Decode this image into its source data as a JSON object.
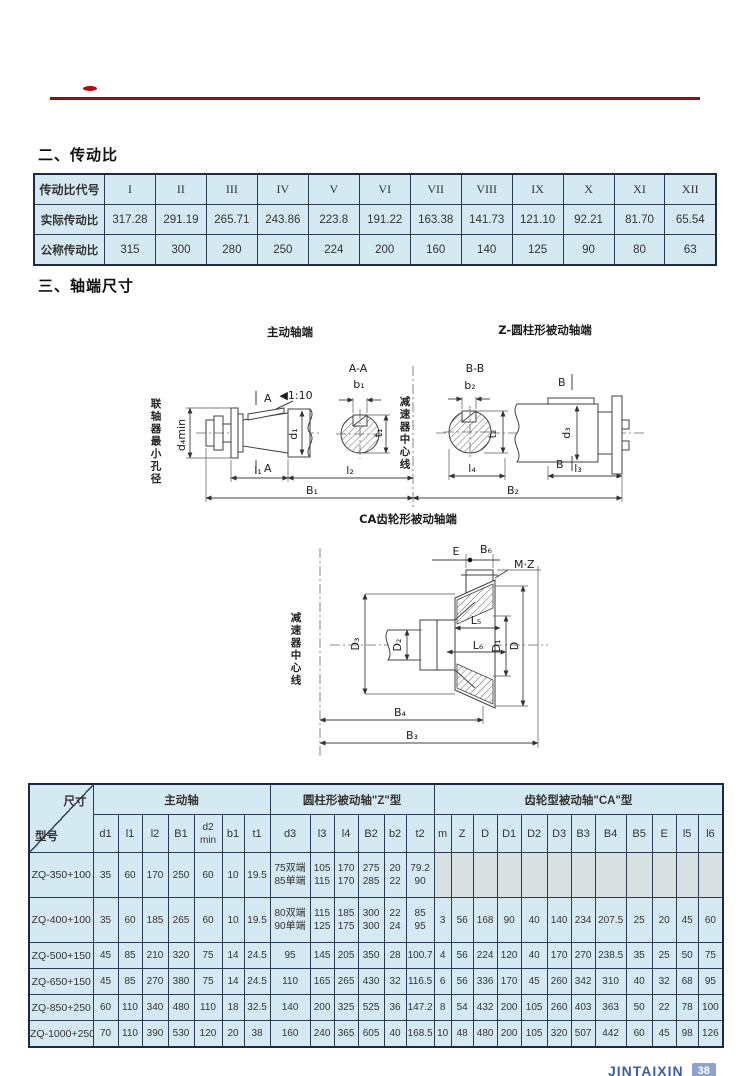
{
  "sections": {
    "ratio_title": "二、传动比",
    "shaft_title": "三、轴端尺寸"
  },
  "ratio_table": {
    "header_label": "传动比代号",
    "codes": [
      "I",
      "II",
      "III",
      "IV",
      "V",
      "VI",
      "VII",
      "VIII",
      "IX",
      "X",
      "XI",
      "XII"
    ],
    "actual_label": "实际传动比",
    "actual": [
      "317.28",
      "291.19",
      "265.71",
      "243.86",
      "223.8",
      "191.22",
      "163.38",
      "141.73",
      "121.10",
      "92.21",
      "81.70",
      "65.54"
    ],
    "nominal_label": "公称传动比",
    "nominal": [
      "315",
      "300",
      "280",
      "250",
      "224",
      "200",
      "160",
      "140",
      "125",
      "90",
      "80",
      "63"
    ]
  },
  "drawings": {
    "center_label": "减速器中心线",
    "driving": {
      "title": "主动轴端",
      "section_label": "A-A",
      "b1": "b₁",
      "t1": "t₁",
      "d1": "d₁",
      "d4min": "d₄min",
      "taper": "◀1:10",
      "a_top": "A",
      "a_bottom": "A",
      "coupling_note": "联轴器最小孔径",
      "l1": "l₁",
      "l2": "l₂",
      "B1": "B₁"
    },
    "cylindrical": {
      "title": "Z-圆柱形被动轴端",
      "section_label": "B-B",
      "b2": "b₂",
      "t2": "t₂",
      "d3": "d₃",
      "B_top": "B",
      "B_bottom": "B",
      "l3": "l₃",
      "l4": "l₄",
      "B2": "B₂"
    },
    "gear": {
      "title": "CA齿轮形被动轴端",
      "E": "E",
      "B6": "B₆",
      "MZ": "M·Z",
      "center_label": "减速器中心线",
      "D": "D",
      "D1": "D₁",
      "D2": "D₂",
      "D3": "D₃",
      "L5": "L₅",
      "L6": "L₆",
      "B3": "B₃",
      "B4": "B₄"
    }
  },
  "dim_table": {
    "corner_top": "尺寸",
    "corner_bottom": "型号",
    "groups": [
      {
        "label": "主动轴",
        "cols": [
          "d1",
          "l1",
          "l2",
          "B1",
          [
            "d2",
            "min"
          ],
          "b1",
          "t1"
        ]
      },
      {
        "label": "圆柱形被动轴\"Z\"型",
        "cols": [
          "d3",
          "l3",
          "l4",
          "B2",
          "b2",
          "t2"
        ]
      },
      {
        "label": "齿轮型被动轴\"CA\"型",
        "cols": [
          "m",
          "Z",
          "D",
          "D1",
          "D2",
          "D3",
          "B3",
          "B4",
          "B5",
          "E",
          "l5",
          "l6"
        ]
      }
    ],
    "rows": [
      {
        "model": "ZQ-350+100",
        "values": [
          "35",
          "60",
          "170",
          "250",
          "60",
          "10",
          "19.5",
          [
            "75双端",
            "85单端"
          ],
          [
            "105",
            "115"
          ],
          [
            "170",
            "170"
          ],
          [
            "275",
            "285"
          ],
          [
            "20",
            "22"
          ],
          [
            "79.2",
            "90"
          ],
          "",
          "",
          "",
          "",
          "",
          "",
          "",
          "",
          "",
          "",
          "",
          ""
        ]
      },
      {
        "model": "ZQ-400+100",
        "values": [
          "35",
          "60",
          "185",
          "265",
          "60",
          "10",
          "19.5",
          [
            "80双端",
            "90单端"
          ],
          [
            "115",
            "125"
          ],
          [
            "185",
            "175"
          ],
          [
            "300",
            "300"
          ],
          [
            "22",
            "24"
          ],
          [
            "85",
            "95"
          ],
          "3",
          "56",
          "168",
          "90",
          "40",
          "140",
          "234",
          "207.5",
          "25",
          "20",
          "45",
          "60"
        ]
      },
      {
        "model": "ZQ-500+150",
        "values": [
          "45",
          "85",
          "210",
          "320",
          "75",
          "14",
          "24.5",
          "95",
          "145",
          "205",
          "350",
          "28",
          "100.7",
          "4",
          "56",
          "224",
          "120",
          "40",
          "170",
          "270",
          "238.5",
          "35",
          "25",
          "50",
          "75"
        ]
      },
      {
        "model": "ZQ-650+150",
        "values": [
          "45",
          "85",
          "270",
          "380",
          "75",
          "14",
          "24.5",
          "110",
          "165",
          "265",
          "430",
          "32",
          "116.5",
          "6",
          "56",
          "336",
          "170",
          "45",
          "260",
          "342",
          "310",
          "40",
          "32",
          "68",
          "95"
        ]
      },
      {
        "model": "ZQ-850+250",
        "values": [
          "60",
          "110",
          "340",
          "480",
          "110",
          "18",
          "32.5",
          "140",
          "200",
          "325",
          "525",
          "36",
          "147.2",
          "8",
          "54",
          "432",
          "200",
          "105",
          "260",
          "403",
          "363",
          "50",
          "22",
          "78",
          "100"
        ]
      },
      {
        "model": "ZQ-1000+250",
        "values": [
          "70",
          "110",
          "390",
          "530",
          "120",
          "20",
          "38",
          "160",
          "240",
          "365",
          "605",
          "40",
          "168.5",
          "10",
          "48",
          "480",
          "200",
          "105",
          "320",
          "507",
          "442",
          "60",
          "45",
          "98",
          "126"
        ]
      }
    ]
  },
  "footer": {
    "brand": "JINTAIXIN",
    "page_number": "38"
  },
  "colors": {
    "cell_bg": "#d5e9f3",
    "border": "#2b3a55",
    "rule_red": "#8f1010",
    "brand_blue": "#3d5fa9",
    "badge_blue": "#8aa3cf"
  }
}
